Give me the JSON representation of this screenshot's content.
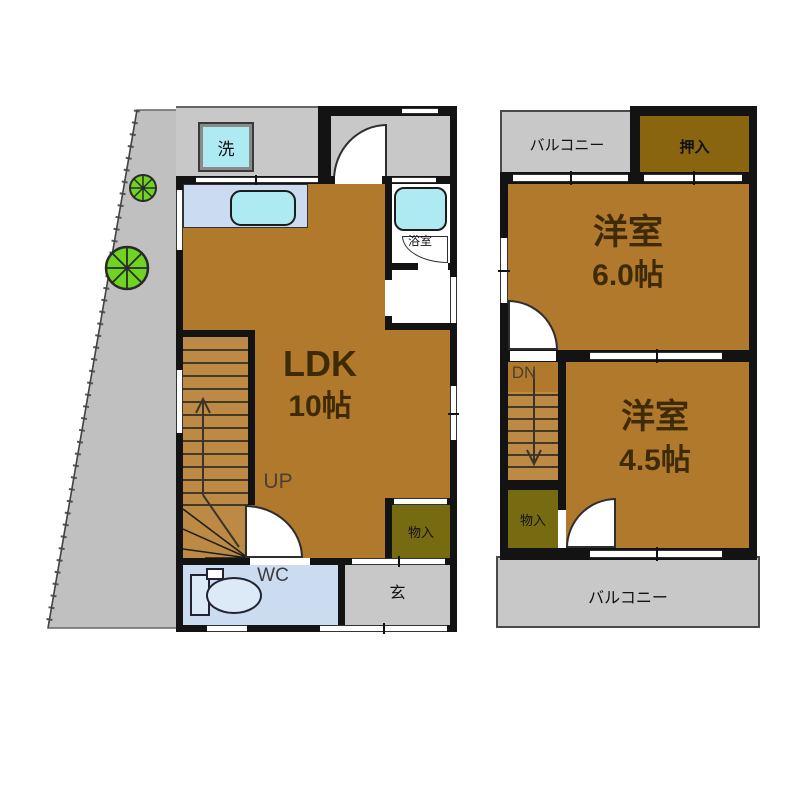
{
  "colors": {
    "wall": "#131313",
    "room_floor_brown": "#b0792c",
    "stair_tread": "#bc8a44",
    "closet_dark_gold": "#8a650f",
    "storage_olive": "#776b12",
    "balcony_gray": "#c8c8c8",
    "land_gray": "#c0c0c0",
    "water_room_blue": "#ccdcf0",
    "fixture_cyan": "#aeeaf2",
    "tree_green": "#6ed321",
    "big_label_brown": "#3f2a06"
  },
  "floor1": {
    "laundry_label": "洗",
    "bathroom_label": "浴室",
    "ldk_name": "LDK",
    "ldk_size": "10帖",
    "stairs_label": "UP",
    "storage_label": "物入",
    "wc_label": "WC",
    "entrance_label": "玄"
  },
  "floor2": {
    "balcony_top_label": "バルコニー",
    "closet_label": "押入",
    "room1_name": "洋室",
    "room1_size": "6.0帖",
    "stairs_label": "DN",
    "room2_name": "洋室",
    "room2_size": "4.5帖",
    "storage_label": "物入",
    "balcony_bottom_label": "バルコニー"
  }
}
